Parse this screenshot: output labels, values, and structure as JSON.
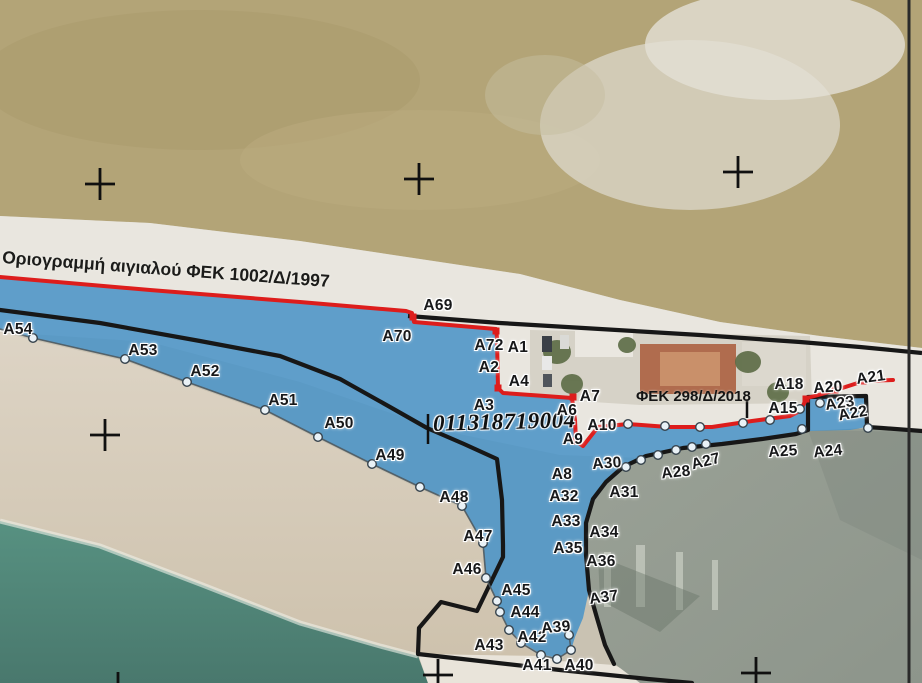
{
  "captions": {
    "boundary_1997": "Οριογραμμή αιγιαλού ΦΕΚ 1002/Δ/1997",
    "fek_2018": "ΦΕΚ 298/Δ/2018",
    "survey_number": "011318719004"
  },
  "colors": {
    "boundary_red": "#dd1d1c",
    "boundary_black": "#171717",
    "zone_blue": "#4b94c7",
    "sea_teal": "#518b7c",
    "land_tan": "#b3a477",
    "beach_white": "#e9e6df",
    "concrete_gray": "#99a095",
    "marker_fill": "#e9f1f6",
    "marker_stroke": "#36434d"
  },
  "point_labels": [
    {
      "t": "A69",
      "x": 438,
      "y": 306,
      "r": 0
    },
    {
      "t": "A70",
      "x": 397,
      "y": 337,
      "r": 0
    },
    {
      "t": "A72",
      "x": 489,
      "y": 346,
      "r": 0
    },
    {
      "t": "A1",
      "x": 518,
      "y": 348,
      "r": 0
    },
    {
      "t": "A2",
      "x": 489,
      "y": 368,
      "r": 0
    },
    {
      "t": "A4",
      "x": 519,
      "y": 382,
      "r": 0
    },
    {
      "t": "A3",
      "x": 484,
      "y": 406,
      "r": 0
    },
    {
      "t": "A7",
      "x": 590,
      "y": 397,
      "r": 0
    },
    {
      "t": "A6",
      "x": 567,
      "y": 411,
      "r": 0
    },
    {
      "t": "A10",
      "x": 602,
      "y": 426,
      "r": 0
    },
    {
      "t": "A9",
      "x": 573,
      "y": 440,
      "r": 0
    },
    {
      "t": "A8",
      "x": 562,
      "y": 475,
      "r": 0
    },
    {
      "t": "A30",
      "x": 607,
      "y": 464,
      "r": -4
    },
    {
      "t": "A31",
      "x": 624,
      "y": 493,
      "r": 0
    },
    {
      "t": "A32",
      "x": 564,
      "y": 497,
      "r": 0
    },
    {
      "t": "A33",
      "x": 566,
      "y": 522,
      "r": 0
    },
    {
      "t": "A34",
      "x": 604,
      "y": 533,
      "r": 0
    },
    {
      "t": "A35",
      "x": 568,
      "y": 549,
      "r": 0
    },
    {
      "t": "A36",
      "x": 601,
      "y": 562,
      "r": 0
    },
    {
      "t": "A37",
      "x": 604,
      "y": 598,
      "r": -8
    },
    {
      "t": "A28",
      "x": 676,
      "y": 473,
      "r": -6
    },
    {
      "t": "A27",
      "x": 706,
      "y": 462,
      "r": -14
    },
    {
      "t": "A25",
      "x": 783,
      "y": 452,
      "r": -4
    },
    {
      "t": "A24",
      "x": 828,
      "y": 452,
      "r": -6
    },
    {
      "t": "A18",
      "x": 789,
      "y": 385,
      "r": 0
    },
    {
      "t": "A15",
      "x": 783,
      "y": 409,
      "r": 0
    },
    {
      "t": "A20",
      "x": 828,
      "y": 388,
      "r": -4
    },
    {
      "t": "A21",
      "x": 871,
      "y": 378,
      "r": -8
    },
    {
      "t": "A23",
      "x": 840,
      "y": 404,
      "r": -8
    },
    {
      "t": "A22",
      "x": 853,
      "y": 414,
      "r": -10
    },
    {
      "t": "A54",
      "x": 18,
      "y": 330,
      "r": 0
    },
    {
      "t": "A53",
      "x": 143,
      "y": 351,
      "r": 0
    },
    {
      "t": "A52",
      "x": 205,
      "y": 372,
      "r": 0
    },
    {
      "t": "A51",
      "x": 283,
      "y": 401,
      "r": 0
    },
    {
      "t": "A50",
      "x": 339,
      "y": 424,
      "r": 0
    },
    {
      "t": "A49",
      "x": 390,
      "y": 456,
      "r": 0
    },
    {
      "t": "A48",
      "x": 454,
      "y": 498,
      "r": 0
    },
    {
      "t": "A47",
      "x": 478,
      "y": 537,
      "r": 0
    },
    {
      "t": "A46",
      "x": 467,
      "y": 570,
      "r": 0
    },
    {
      "t": "A45",
      "x": 516,
      "y": 591,
      "r": 0
    },
    {
      "t": "A44",
      "x": 525,
      "y": 613,
      "r": 0
    },
    {
      "t": "A43",
      "x": 489,
      "y": 646,
      "r": 0
    },
    {
      "t": "A42",
      "x": 532,
      "y": 638,
      "r": 0
    },
    {
      "t": "A39",
      "x": 556,
      "y": 628,
      "r": -5
    },
    {
      "t": "A41",
      "x": 537,
      "y": 666,
      "r": 0
    },
    {
      "t": "A40",
      "x": 579,
      "y": 666,
      "r": 0
    }
  ],
  "circle_markers": [
    [
      33,
      338
    ],
    [
      125,
      359
    ],
    [
      187,
      382
    ],
    [
      265,
      410
    ],
    [
      318,
      437
    ],
    [
      372,
      464
    ],
    [
      420,
      487
    ],
    [
      462,
      506
    ],
    [
      483,
      543
    ],
    [
      486,
      578
    ],
    [
      497,
      601
    ],
    [
      500,
      612
    ],
    [
      509,
      630
    ],
    [
      521,
      643
    ],
    [
      541,
      655
    ],
    [
      557,
      659
    ],
    [
      571,
      650
    ],
    [
      569,
      635
    ],
    [
      628,
      424
    ],
    [
      665,
      426
    ],
    [
      700,
      427
    ],
    [
      743,
      423
    ],
    [
      770,
      420
    ],
    [
      800,
      409
    ],
    [
      626,
      467
    ],
    [
      641,
      460
    ],
    [
      658,
      455
    ],
    [
      676,
      450
    ],
    [
      692,
      447
    ],
    [
      706,
      444
    ],
    [
      820,
      403
    ],
    [
      845,
      405
    ],
    [
      862,
      409
    ],
    [
      802,
      429
    ],
    [
      868,
      428
    ]
  ],
  "vertex_squares": [
    [
      413,
      317
    ],
    [
      496,
      331
    ],
    [
      498,
      388
    ],
    [
      573,
      397
    ],
    [
      576,
      441
    ],
    [
      806,
      399
    ],
    [
      835,
      390
    ],
    [
      863,
      381
    ]
  ],
  "survey_crosses": [
    [
      100,
      184
    ],
    [
      419,
      179
    ],
    [
      738,
      172
    ],
    [
      105,
      435
    ],
    [
      438,
      675
    ],
    [
      756,
      673
    ],
    [
      118,
      688
    ]
  ],
  "geometry": {
    "red_line": "0,277 150,290 300,302 406,311 412,313 414,322 496,329 497,338 498,388 503,393 545,396 572,398 575,420 576,441 583,446 598,427 628,424 668,427 712,427 752,421 790,416 800,411 807,398 822,394 836,390 864,381 893,380",
    "black_west": "0,310 100,323 200,341 280,356 340,379 390,407 427,428 464,444 497,459 502,500 503,545 503,557 477,611 441,602 419,628 418,654 480,661 560,670 648,679 692,683",
    "black_east": "614,664 605,645 597,618 589,590 586,555 586,523 593,499 606,482 623,467 646,456 683,448 722,444 762,439 796,434 808,430 808,397 866,396 867,427 882,428 922,431",
    "road_line": "408,316 500,323 600,329 700,335 800,342 860,347 922,353",
    "coastline": "0,329 33,338 125,359 187,382 265,410 318,437 372,464 420,487 462,506 483,543 486,578 497,601 500,612 509,630 521,643 541,655 557,659 571,650 569,635",
    "zone_polygon": "0,277 406,311 412,313 414,322 496,329 498,388 503,393 545,396 572,398 576,441 584,446 598,427 628,424 668,427 712,427 752,421 790,416 800,411 807,398 866,396 867,427 850,430 810,431 796,434 762,439 722,444 683,448 646,456 623,467 606,482 593,499 586,523 586,555 589,590 583,618 575,637 571,650 557,658 541,654 521,642 509,629 500,611 497,600 486,578 483,543 462,506 420,487 372,464 318,437 265,410 187,382 125,359 33,338 0,329",
    "frame_line": "909,0 909,683",
    "ticks": [
      [
        428,
        414,
        428,
        444
      ],
      [
        747,
        399,
        747,
        418
      ]
    ]
  }
}
